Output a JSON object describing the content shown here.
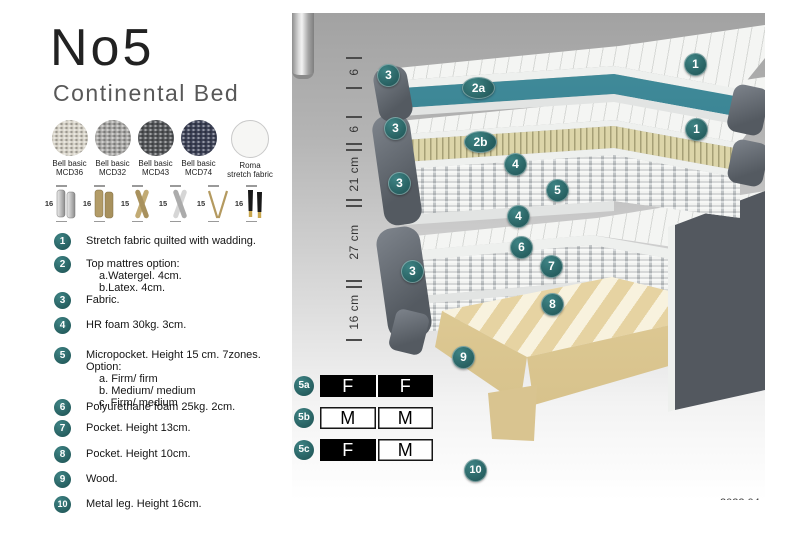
{
  "product": {
    "title": "No5",
    "subtitle": "Continental Bed"
  },
  "fabric_swatches": [
    {
      "line1": "Bell basic",
      "line2": "MCD36",
      "color": "#d7d3c8"
    },
    {
      "line1": "Bell basic",
      "line2": "MCD32",
      "color": "#a9a8a6"
    },
    {
      "line1": "Bell basic",
      "line2": "MCD43",
      "color": "#55575a"
    },
    {
      "line1": "Bell basic",
      "line2": "MCD74",
      "color": "#3d4257"
    },
    {
      "line1": "Roma",
      "line2": "stretch fabric",
      "color": "#f6f6f4"
    }
  ],
  "leg_options": [
    {
      "height": "16",
      "type": "cylinder-silver"
    },
    {
      "height": "16",
      "type": "cylinder-gold"
    },
    {
      "height": "15",
      "type": "cross-gold"
    },
    {
      "height": "15",
      "type": "cross-silver"
    },
    {
      "height": "15",
      "type": "hairpin-gold"
    },
    {
      "height": "16",
      "type": "tapered-black-gold"
    }
  ],
  "legend": [
    {
      "num": "1",
      "text": "Stretch fabric quilted with wadding."
    },
    {
      "num": "2",
      "text": "Top mattres option:",
      "sub": [
        "a.Watergel. 4cm.",
        "b.Latex. 4cm."
      ]
    },
    {
      "num": "3",
      "text": "Fabric."
    },
    {
      "num": "4",
      "text": "HR foam 30kg. 3cm."
    },
    {
      "num": "5",
      "text": "Micropocket. Height 15 cm. 7zones. Option:",
      "sub": [
        "a. Firm/ firm",
        "b. Medium/ medium",
        "c. Firm/ medium"
      ]
    },
    {
      "num": "6",
      "text": "Polyurethane foam 25kg. 2cm."
    },
    {
      "num": "7",
      "text": "Pocket. Height 13cm."
    },
    {
      "num": "8",
      "text": "Pocket. Height 10cm."
    },
    {
      "num": "9",
      "text": "Wood."
    },
    {
      "num": "10",
      "text": "Metal leg. Height 16cm."
    }
  ],
  "diagram": {
    "dimensions": [
      "6",
      "6",
      "21 cm",
      "27 cm",
      "16 cm"
    ],
    "callouts": [
      {
        "id": "1a",
        "label": "1"
      },
      {
        "id": "1b",
        "label": "1"
      },
      {
        "id": "2a",
        "label": "2a"
      },
      {
        "id": "2b",
        "label": "2b"
      },
      {
        "id": "3a",
        "label": "3"
      },
      {
        "id": "3b",
        "label": "3"
      },
      {
        "id": "3c",
        "label": "3"
      },
      {
        "id": "3d",
        "label": "3"
      },
      {
        "id": "4a",
        "label": "4"
      },
      {
        "id": "4b",
        "label": "4"
      },
      {
        "id": "5",
        "label": "5"
      },
      {
        "id": "6",
        "label": "6"
      },
      {
        "id": "7",
        "label": "7"
      },
      {
        "id": "8",
        "label": "8"
      },
      {
        "id": "9",
        "label": "9"
      },
      {
        "id": "10",
        "label": "10"
      }
    ],
    "firmness_table": [
      {
        "row": "5a",
        "cells": [
          {
            "v": "F",
            "style": "dark"
          },
          {
            "v": "F",
            "style": "dark"
          }
        ]
      },
      {
        "row": "5b",
        "cells": [
          {
            "v": "M",
            "style": "light"
          },
          {
            "v": "M",
            "style": "light"
          }
        ]
      },
      {
        "row": "5c",
        "cells": [
          {
            "v": "F",
            "style": "dark"
          },
          {
            "v": "M",
            "style": "light"
          }
        ]
      }
    ],
    "version": "2022.04",
    "colors": {
      "callout_teal": "#2b6d6d",
      "watergel_teal": "#2e7d8e",
      "latex_cream": "#d8d1a4",
      "fabric_gray": "#5d636b",
      "wood_tan": "#e9d8ab"
    }
  }
}
